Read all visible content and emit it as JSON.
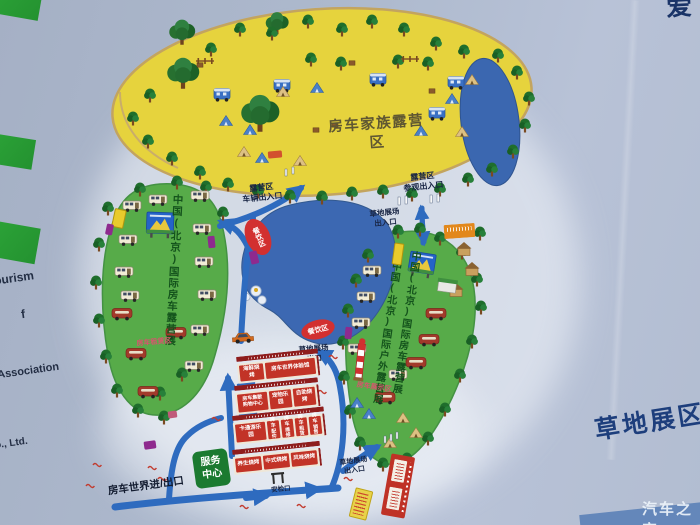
{
  "photo": {
    "watermark": "汽车之家",
    "corner_glyph": "爱"
  },
  "sign": {
    "side_label": "草地展区",
    "left_fragments": {
      "f1": "ourism",
      "f2": "f",
      "f3": "Association",
      "f4": "o., Ltd."
    }
  },
  "map": {
    "camp": {
      "title": "房车家族露营区",
      "vehicle_entrance": "露营区\n车辆出入口",
      "visitor_entrance": "露营区\n参观出入口"
    },
    "grass": {
      "exit_top": "草地展场\n出入口",
      "exit_mid": "草地展场\n出口",
      "entrance_bottom": "草地展场\n出入口"
    },
    "left_zone": {
      "title": "中国(北京)国际房车露营展",
      "sub": "房车租赁区"
    },
    "right_zone": {
      "title_a": "中国(北京)国际房车露营展",
      "title_b": "中国(北京)国际户外露营展",
      "sub": "房车展示区"
    },
    "dining": {
      "a": "餐饮区",
      "b": "餐饮区"
    },
    "facilities": {
      "service_center": "服务\n中心",
      "gate_label": "房车世界进/出口",
      "security_label": "安检口"
    },
    "buildings": {
      "row1": {
        "b1": "海鲜烧烤",
        "b2": "房车世界体验馆"
      },
      "row2": {
        "b1": "房车集散\n购物中心",
        "b2": "宠物乐园",
        "b3": "自助烧烤"
      },
      "row3": {
        "b1": "卡通游乐园",
        "b2": "房车\n配件",
        "b3": "房车\n维修",
        "b4": "房车\n租赁",
        "b5": "房车\n销售"
      },
      "row4": {
        "b1": "养生烧烤",
        "b2": "中式烧烤",
        "b3": "风味烧烤"
      }
    }
  },
  "colors": {
    "sign_bg": "#aeb9cb",
    "camp_yellow": "#e6d33d",
    "zone_green": "#57ab49",
    "lake_blue": "#3c68b2",
    "road_blue": "#2e6bbf",
    "building_red": "#c23327",
    "accent_text": "#1d3e7c"
  }
}
